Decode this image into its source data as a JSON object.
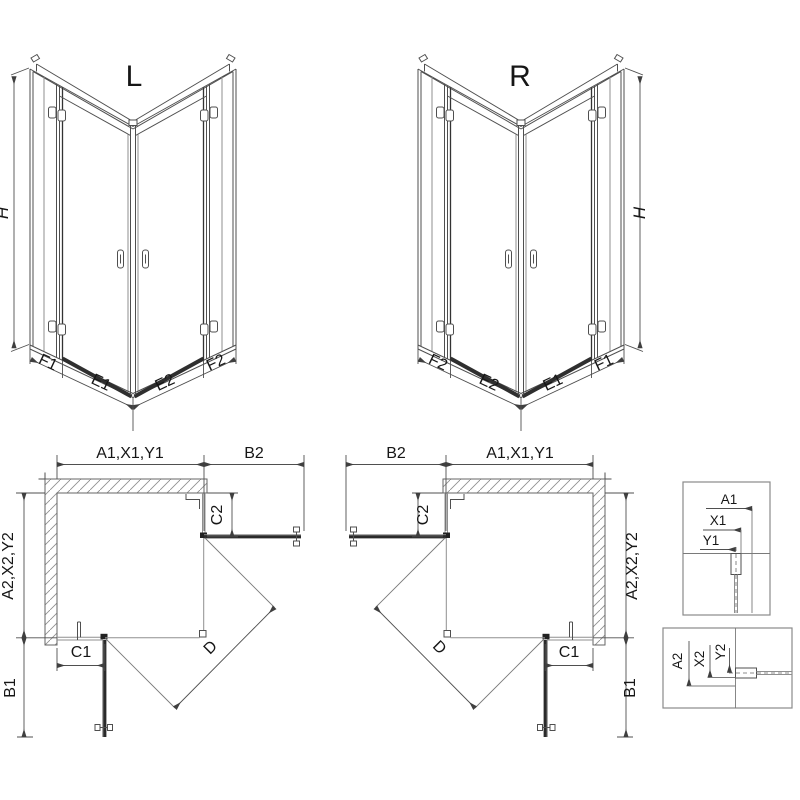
{
  "drawing": {
    "colors": {
      "line": "#4f4f4f",
      "dark": "#2a2a2a",
      "background": "#ffffff"
    }
  },
  "views": {
    "left_3d": {
      "name": "L",
      "height": "H",
      "base_dims": [
        "F1",
        "E1",
        "E2",
        "F2"
      ]
    },
    "right_3d": {
      "name": "R",
      "height": "H",
      "base_dims": [
        "F2",
        "E2",
        "E1",
        "F1"
      ]
    },
    "left_plan": {
      "top_width": "A1,X1,Y1",
      "door_side": "B2",
      "fixed_side": "C2",
      "depth": "A2,X2,Y2",
      "fixed_front": "C1",
      "door_front": "B1",
      "diagonal": "D"
    },
    "right_plan": {
      "top_width": "A1,X1,Y1",
      "door_side": "B2",
      "fixed_side": "C2",
      "depth": "A2,X2,Y2",
      "fixed_front": "C1",
      "door_front": "B1",
      "diagonal": "D"
    },
    "detail_top": {
      "dims": [
        "A1",
        "X1",
        "Y1"
      ]
    },
    "detail_bottom": {
      "dims": [
        "A2",
        "X2",
        "Y2"
      ]
    }
  }
}
